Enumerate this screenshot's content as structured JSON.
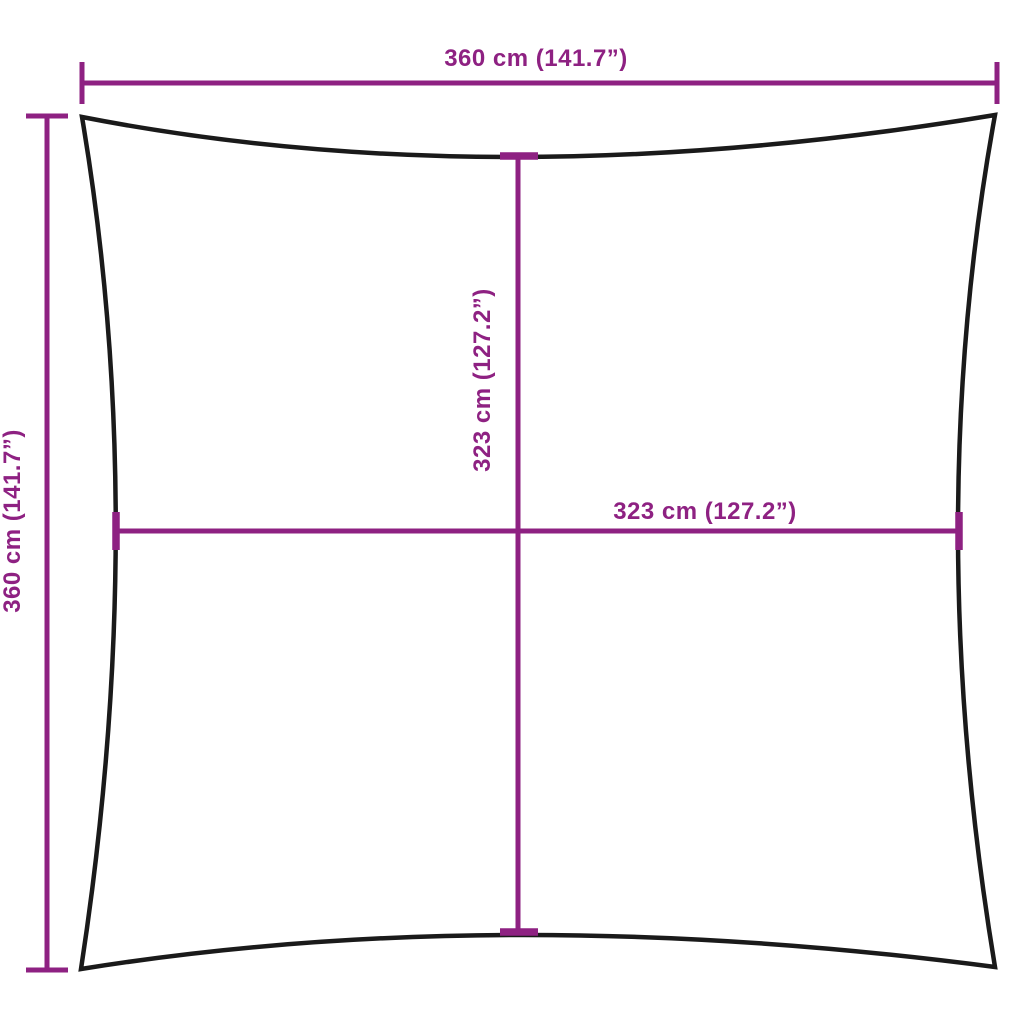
{
  "colors": {
    "dimension": "#8e2182",
    "outline": "#1a1a1a",
    "background": "#ffffff"
  },
  "dimensions": {
    "top_width": {
      "label": "360 cm (141.7”)"
    },
    "left_height": {
      "label": "360 cm (141.7”)"
    },
    "inner_height": {
      "label": "323 cm (127.2”)"
    },
    "inner_width": {
      "label": "323 cm (127.2”)"
    }
  }
}
